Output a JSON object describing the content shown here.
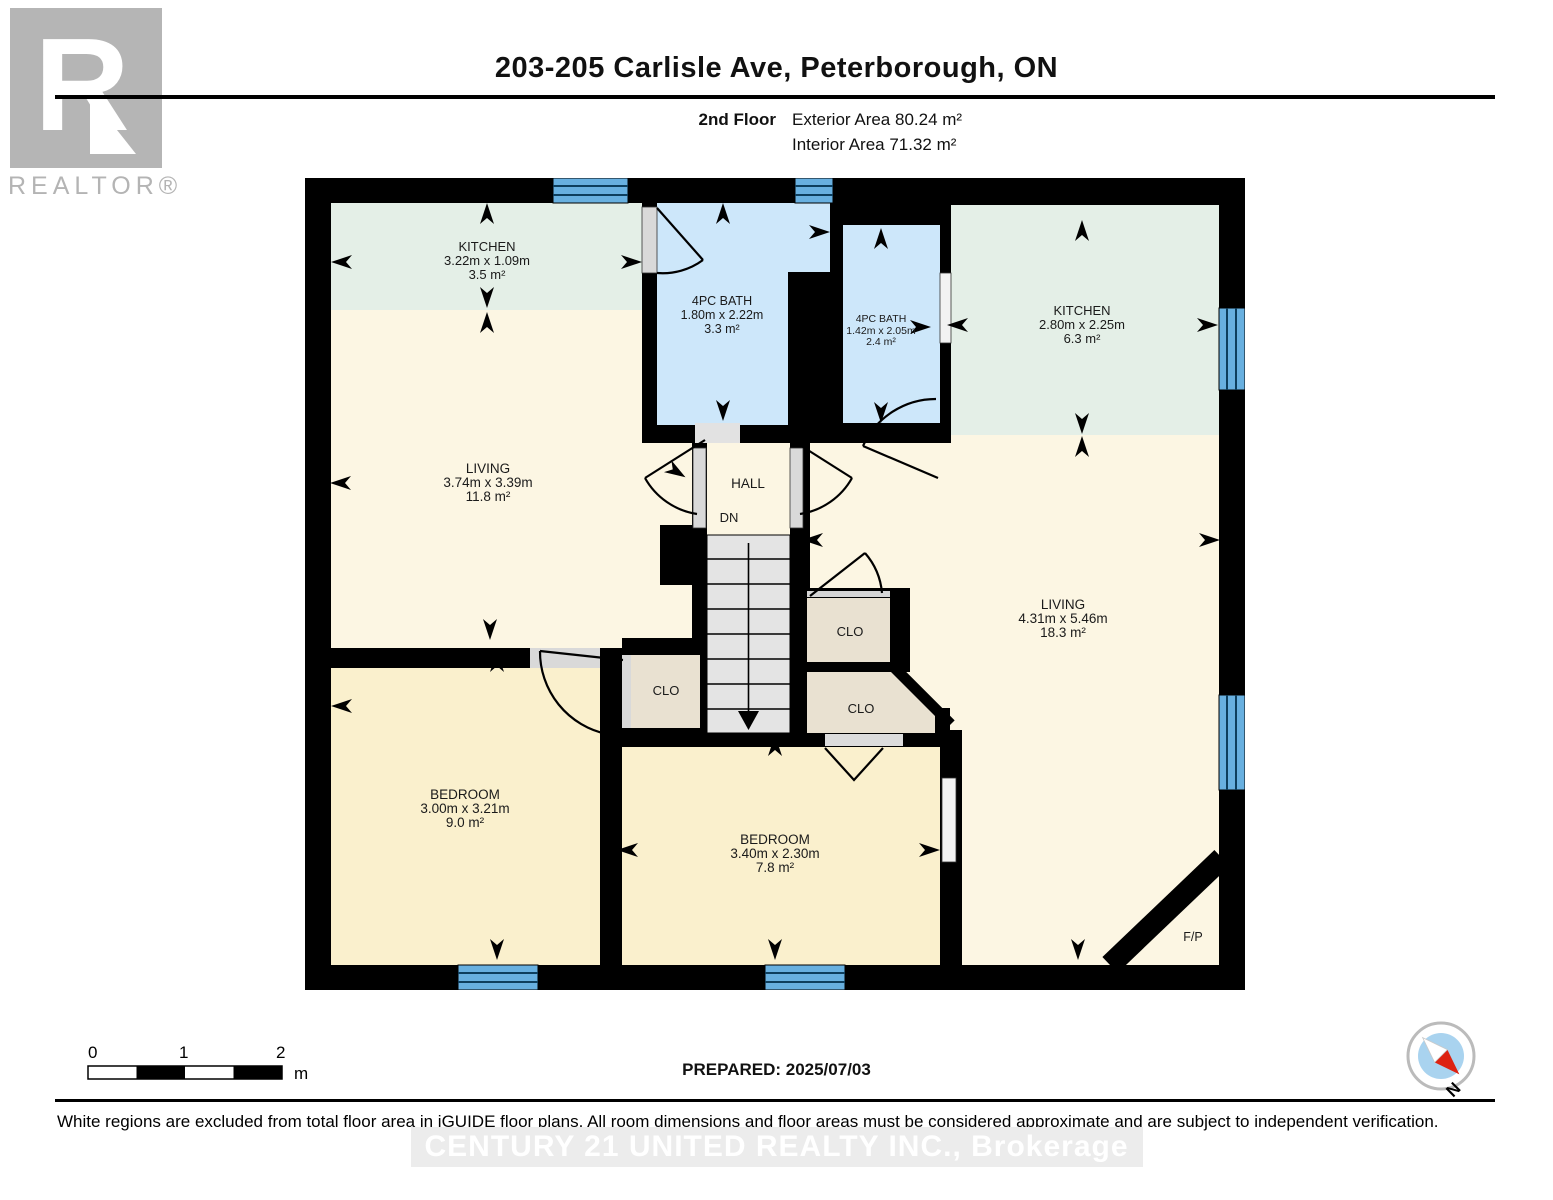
{
  "header": {
    "title": "203-205 Carlisle Ave, Peterborough, ON",
    "floor_label": "2nd Floor",
    "exterior_area": "Exterior Area 80.24 m²",
    "interior_area": "Interior Area 71.32 m²"
  },
  "branding": {
    "realtor_r": "R",
    "realtor_word": "REALTOR®",
    "watermark": "CENTURY 21 UNITED REALTY INC., Brokerage"
  },
  "rooms": {
    "kitchen_left": {
      "name": "KITCHEN",
      "dims": "3.22m x 1.09m",
      "area": "3.5 m²"
    },
    "bath_main": {
      "name": "4PC BATH",
      "dims": "1.80m x 2.22m",
      "area": "3.3 m²"
    },
    "bath_second": {
      "name": "4PC BATH",
      "dims": "1.42m x 2.05m",
      "area": "2.4 m²"
    },
    "kitchen_right": {
      "name": "KITCHEN",
      "dims": "2.80m x 2.25m",
      "area": "6.3 m²"
    },
    "living_left": {
      "name": "LIVING",
      "dims": "3.74m x 3.39m",
      "area": "11.8 m²"
    },
    "living_right": {
      "name": "LIVING",
      "dims": "4.31m x 5.46m",
      "area": "18.3 m²"
    },
    "bedroom_left": {
      "name": "BEDROOM",
      "dims": "3.00m x 3.21m",
      "area": "9.0 m²"
    },
    "bedroom_center": {
      "name": "BEDROOM",
      "dims": "3.40m x 2.30m",
      "area": "7.8 m²"
    },
    "hall": {
      "name": "HALL",
      "stair_label": "DN"
    },
    "closet_label": "CLO",
    "fireplace_label": "F/P"
  },
  "scale_bar": {
    "tick0": "0",
    "tick1": "1",
    "tick2": "2",
    "unit": "m"
  },
  "footer": {
    "prepared": "PREPARED: 2025/07/03",
    "disclaimer": "White regions are excluded from total floor area in iGUIDE floor plans. All room dimensions and floor areas must be considered approximate and are subject to independent verification.",
    "compass_label": "N"
  },
  "colors": {
    "wall": "#000000",
    "kitchen": "#e4efe7",
    "living": "#fcf6e3",
    "bedroom": "#faf0cd",
    "bath": "#cde7fa",
    "closet": "#e9e1d1",
    "window": "#68b0e0",
    "stairs": "#e4e4e4",
    "compass_red": "#dd2211",
    "compass_blue": "#a9d3ef"
  }
}
